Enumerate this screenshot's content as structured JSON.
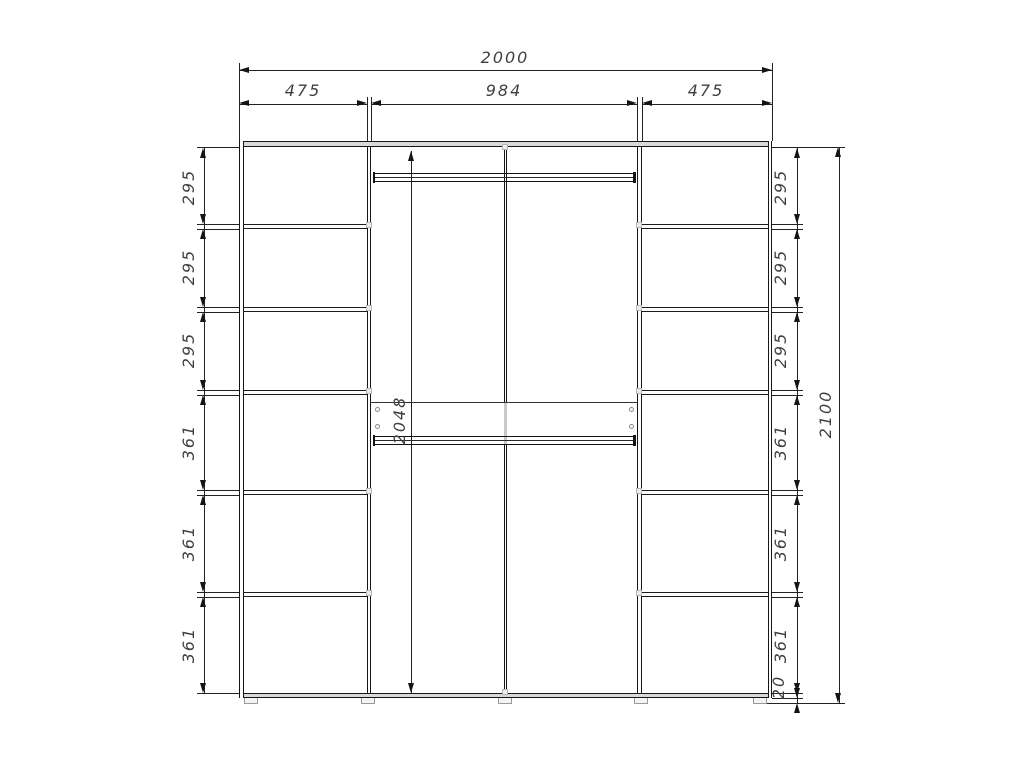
{
  "dimensions": {
    "overall_width": "2000",
    "width_sections": [
      "475",
      "984",
      "475"
    ],
    "left_heights": [
      "295",
      "295",
      "295",
      "361",
      "361",
      "361"
    ],
    "right_heights": [
      "295",
      "295",
      "295",
      "361",
      "361",
      "361"
    ],
    "plinth_height": "20",
    "overall_height": "2100",
    "interior_height": "2048"
  },
  "colors": {
    "line": "#1a1a1a",
    "panel_fill": "#d9d9d9",
    "hardware": "#b5b5b5",
    "text": "#3f3f3f",
    "background": "#ffffff"
  }
}
